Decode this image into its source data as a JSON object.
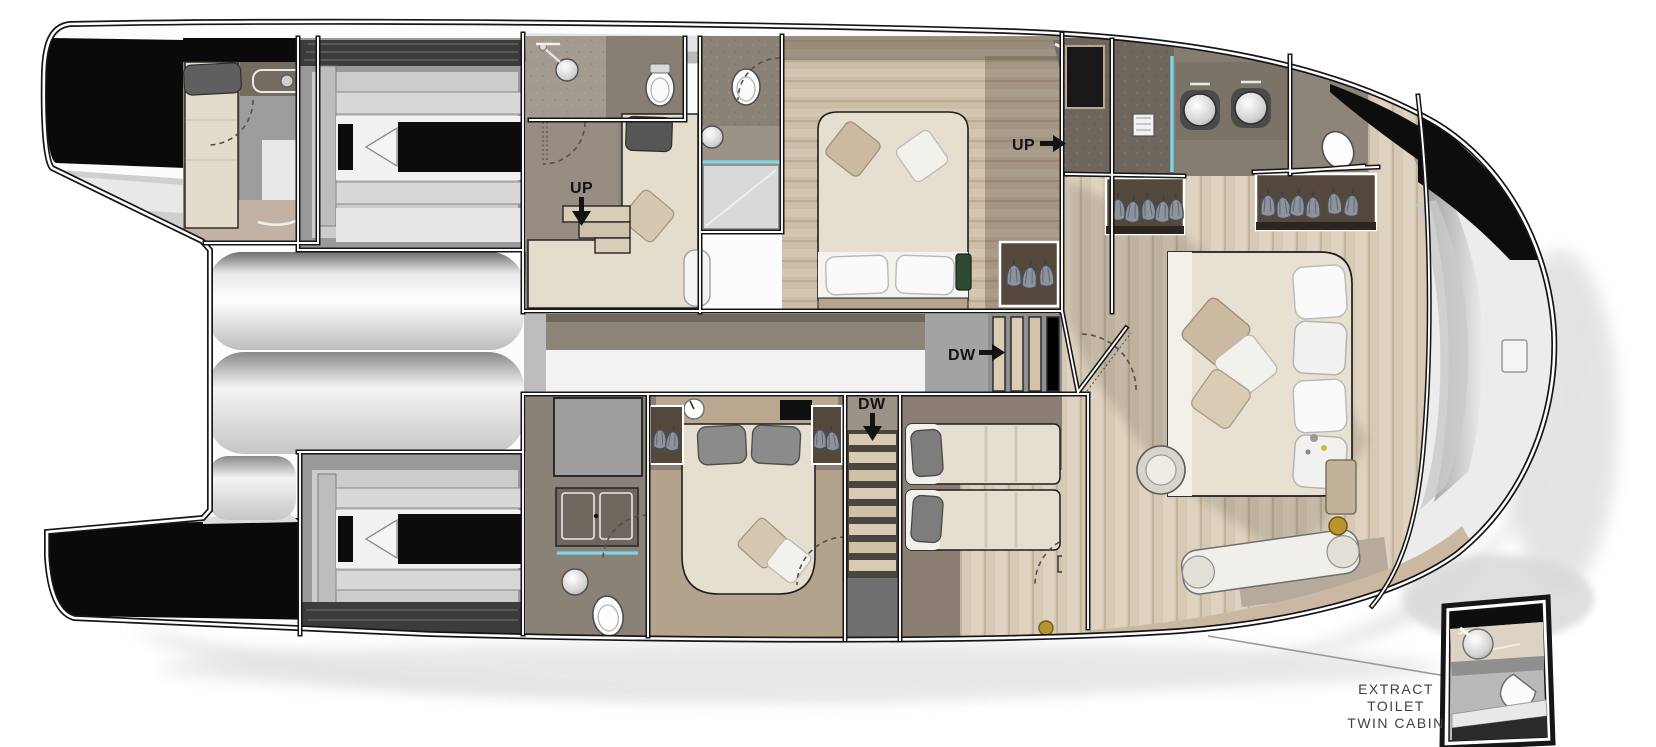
{
  "plan": {
    "kind": "catamaran-yacht-deck-floor-plan",
    "labels": {
      "up_mid_cabin": "UP",
      "up_vip": "UP",
      "dw_corridor": "DW",
      "dw_stairwell": "DW"
    },
    "callout": {
      "line1": "EXTRACT",
      "line2": "TOILET",
      "line3": "TWIN CABIN"
    },
    "icons": {
      "arrow-right-icon": "solid right arrow",
      "arrow-down-icon": "solid down arrow",
      "bed-icon": "cream rectangle with pillows",
      "toilet-icon": "white oval pan",
      "sink-icon": "round basin",
      "wardrobe-icon": "hanging garments",
      "stairs-icon": "striped treads",
      "engine-icon": "black block with shaft cone"
    },
    "colors": {
      "background": "#ffffff",
      "hull_outline": "#161616",
      "panel_black": "#0a0a0a",
      "floor_taupe": "#8d847a",
      "floor_dark_taupe": "#6f675e",
      "floor_tan": "#c9b7a2",
      "floor_wood": "#d8c9b5",
      "bed_cream": "#e6dfcf",
      "pillow_white": "#f5f5f4",
      "pillow_gray": "#7d7d7d",
      "glass_cyan": "#7fd6ea",
      "stair_tread": "#dbcdb4",
      "engine_bay": "#9a9a9a",
      "shadow": "#dcdcdc",
      "label_black": "#131313",
      "callout_gray": "#3f3f3f",
      "brass": "#b8962f"
    }
  }
}
